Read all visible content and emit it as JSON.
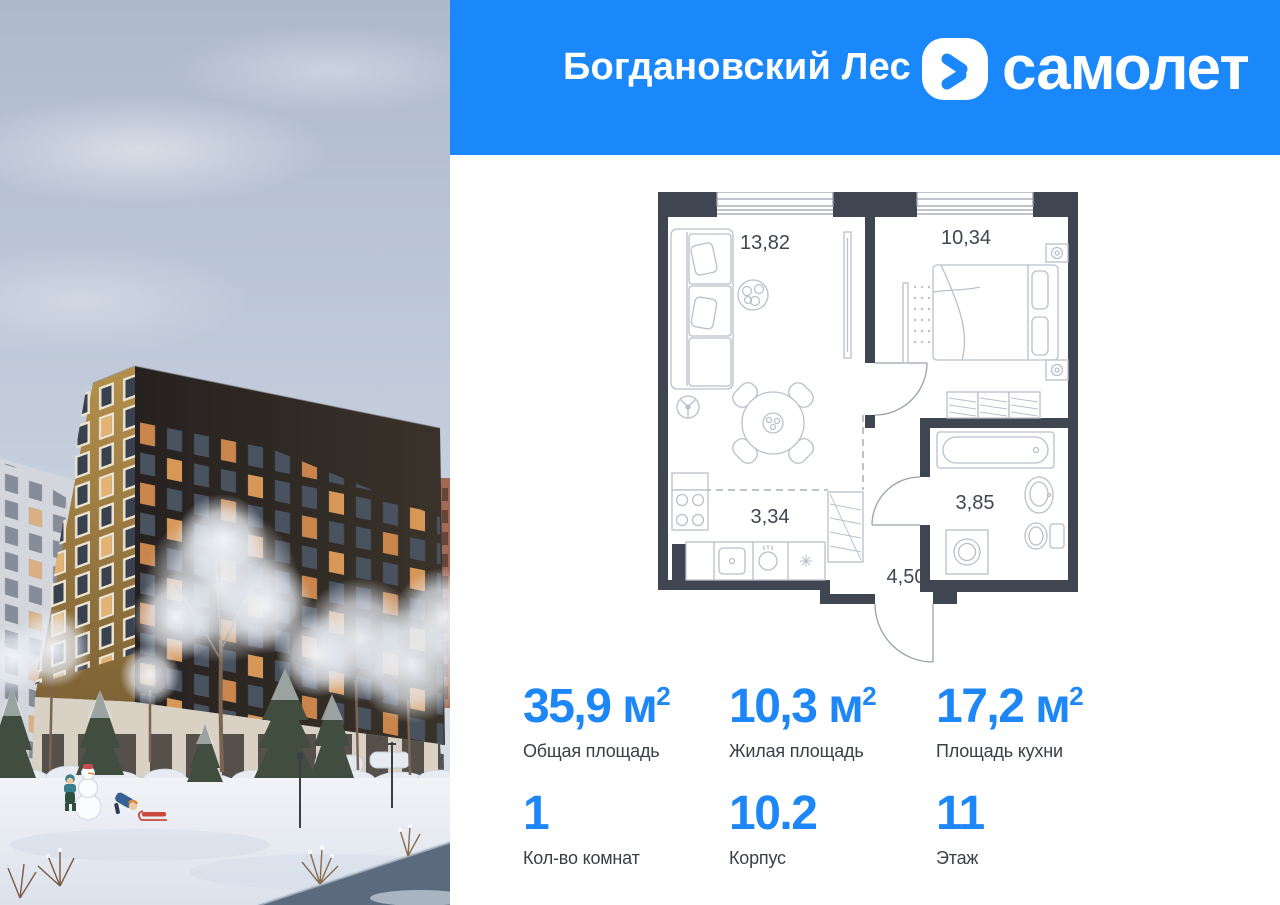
{
  "header": {
    "project_name": "Богдановский Лес",
    "brand_name": "самолет",
    "background_color": "#1A88FB"
  },
  "floor_plan": {
    "wall_color": "#3F4652",
    "rooms": [
      {
        "name": "living-room",
        "area": "13,82"
      },
      {
        "name": "bedroom",
        "area": "10,34"
      },
      {
        "name": "kitchen-zone",
        "area": "3,34"
      },
      {
        "name": "bathroom",
        "area": "3,85"
      },
      {
        "name": "hallway",
        "area": "4,50"
      }
    ]
  },
  "stats": {
    "accent_color": "#1E87F7",
    "items": [
      {
        "value": "35,9",
        "unit": " м",
        "sup": "2",
        "label": "Общая площадь"
      },
      {
        "value": "10,3",
        "unit": " м",
        "sup": "2",
        "label": "Жилая площадь"
      },
      {
        "value": "17,2",
        "unit": " м",
        "sup": "2",
        "label": "Площадь кухни"
      },
      {
        "value": "1",
        "unit": "",
        "sup": "",
        "label": "Кол-во комнат"
      },
      {
        "value": "10.2",
        "unit": "",
        "sup": "",
        "label": "Корпус"
      },
      {
        "value": "11",
        "unit": "",
        "sup": "",
        "label": "Этаж"
      }
    ]
  },
  "photo": {
    "scene": "winter-courtyard-render",
    "sky_color": "#C6D0DE",
    "building_color": "#2B2521",
    "corner_building_color": "#A98444",
    "snow_color": "#EDF0F5"
  }
}
